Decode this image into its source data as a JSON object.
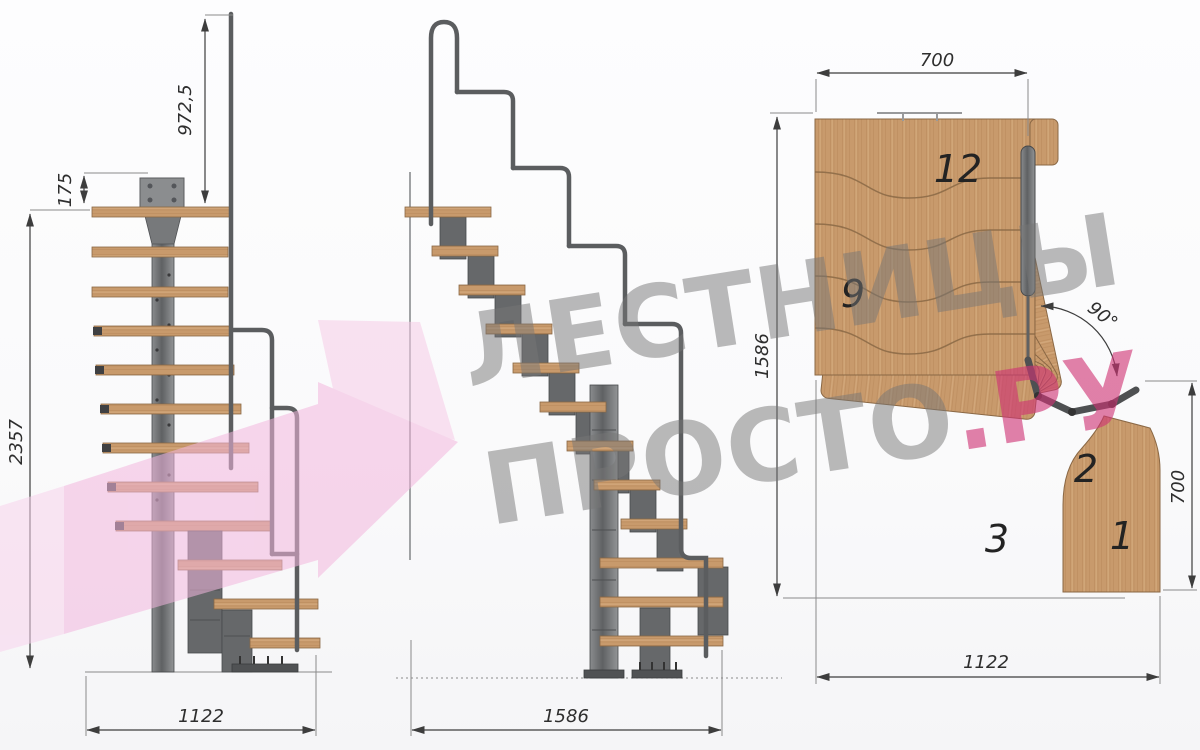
{
  "watermark": {
    "line1": "ЛЕСТНИЦЫ",
    "line2_gray": "ПРОСТО",
    "line2_pink": ".РУ"
  },
  "views": {
    "front": {
      "dims": {
        "rail_height": "972,5",
        "top_offset": "175",
        "total_height": "2357",
        "width": "1122"
      }
    },
    "side": {
      "dims": {
        "length": "1586"
      }
    },
    "plan": {
      "dims": {
        "top_width": "700",
        "left_length": "1586",
        "right_width": "700",
        "bottom_length": "1122",
        "angle": "90°"
      },
      "steps": {
        "n12": "12",
        "n9": "9",
        "n3": "3",
        "n2": "2",
        "n1": "1"
      }
    }
  },
  "colors": {
    "background": "#fbfbfc",
    "wood": "#c89a6c",
    "wood_grain": "#b8875a",
    "metal": "#6a6c6e",
    "metal_dark": "#4b4d4f",
    "dimension_line": "#3d3d3d",
    "watermark_gray": "#767676",
    "watermark_pink": "#ce3474",
    "arrow_pink": "#f3b7de"
  }
}
